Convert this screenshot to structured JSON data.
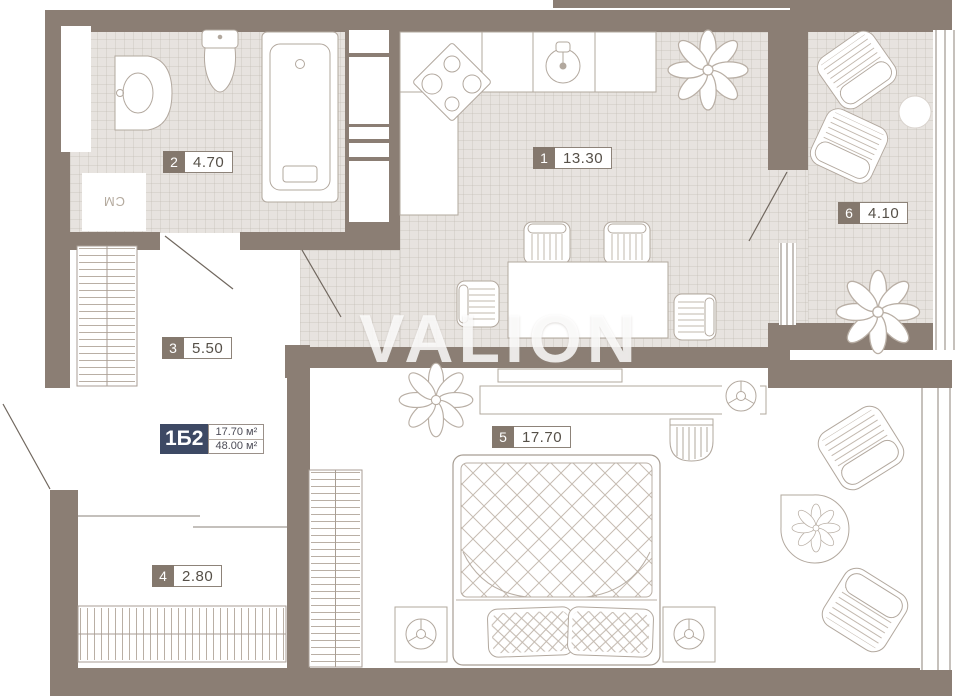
{
  "watermark": "VALION",
  "apartment_badge": {
    "code": "1Б2",
    "upper_area": "17.70 м²",
    "lower_area": "48.00 м²"
  },
  "rooms": [
    {
      "number": "1",
      "area": "13.30"
    },
    {
      "number": "2",
      "area": "4.70"
    },
    {
      "number": "3",
      "area": "5.50"
    },
    {
      "number": "4",
      "area": "2.80"
    },
    {
      "number": "5",
      "area": "17.70"
    },
    {
      "number": "6",
      "area": "4.10"
    }
  ],
  "appliances": {
    "washing_machine": "СМ"
  },
  "colors": {
    "wall": "#8b7e74",
    "tile": "#e7e3df",
    "badge_navy": "#3d4964",
    "outline": "#b2a89e"
  }
}
